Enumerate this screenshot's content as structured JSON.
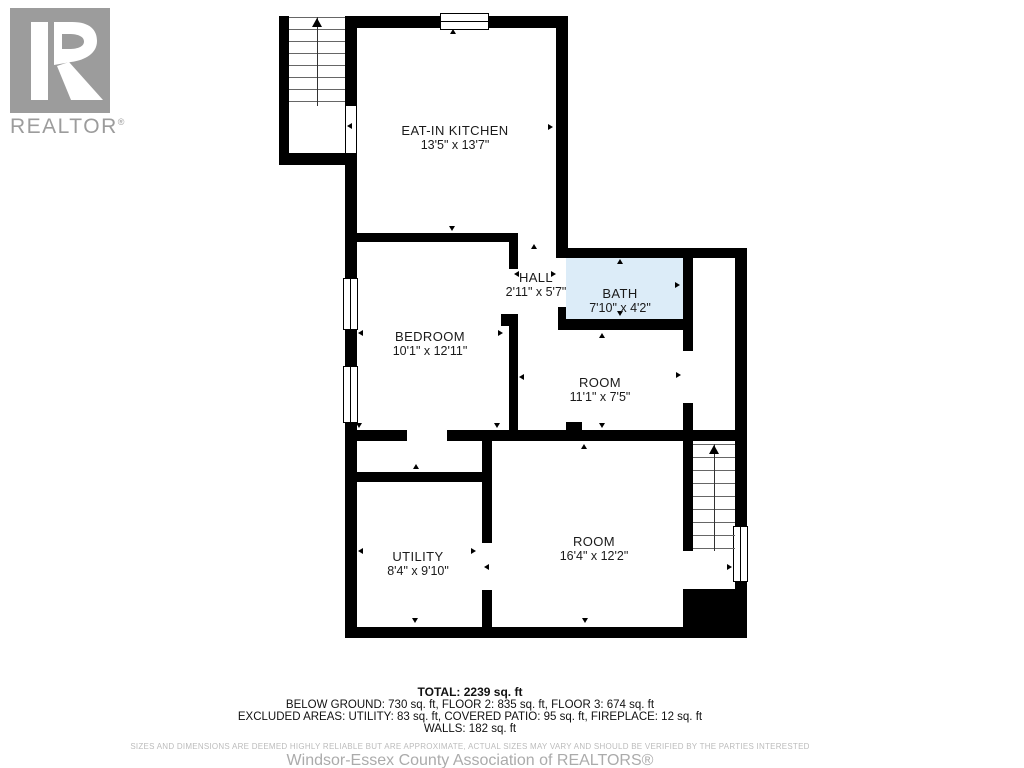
{
  "branding": {
    "logo_text": "REALTOR",
    "logo_registered": "®",
    "logo_color": "#9c9c9c"
  },
  "floor_plan": {
    "bath_fill_color": "#dcecf8",
    "rooms": [
      {
        "name": "EAT-IN KITCHEN",
        "dimensions": "13'5\" x 13'7\""
      },
      {
        "name": "BEDROOM",
        "dimensions": "10'1\" x 12'11\""
      },
      {
        "name": "HALL",
        "dimensions": "2'11\" x 5'7\""
      },
      {
        "name": "BATH",
        "dimensions": "7'10\" x 4'2\""
      },
      {
        "name": "ROOM",
        "dimensions": "11'1\" x 7'5\""
      },
      {
        "name": "UTILITY",
        "dimensions": "8'4\" x 9'10\""
      },
      {
        "name": "ROOM",
        "dimensions": "16'4\" x 12'2\""
      }
    ]
  },
  "summary": {
    "total": "TOTAL: 2239 sq. ft",
    "floors": "BELOW GROUND: 730 sq. ft, FLOOR 2: 835 sq. ft, FLOOR 3: 674 sq. ft",
    "excluded": "EXCLUDED AREAS: UTILITY: 83 sq. ft, COVERED PATIO: 95 sq. ft, FIREPLACE: 12 sq. ft",
    "walls": "WALLS: 182 sq. ft"
  },
  "footer": {
    "disclaimer": "SIZES AND DIMENSIONS ARE DEEMED HIGHLY RELIABLE BUT ARE APPROXIMATE, ACTUAL SIZES MAY VARY AND SHOULD BE VERIFIED BY THE PARTIES INTERESTED",
    "association": "Windsor-Essex County Association of REALTORS®"
  }
}
